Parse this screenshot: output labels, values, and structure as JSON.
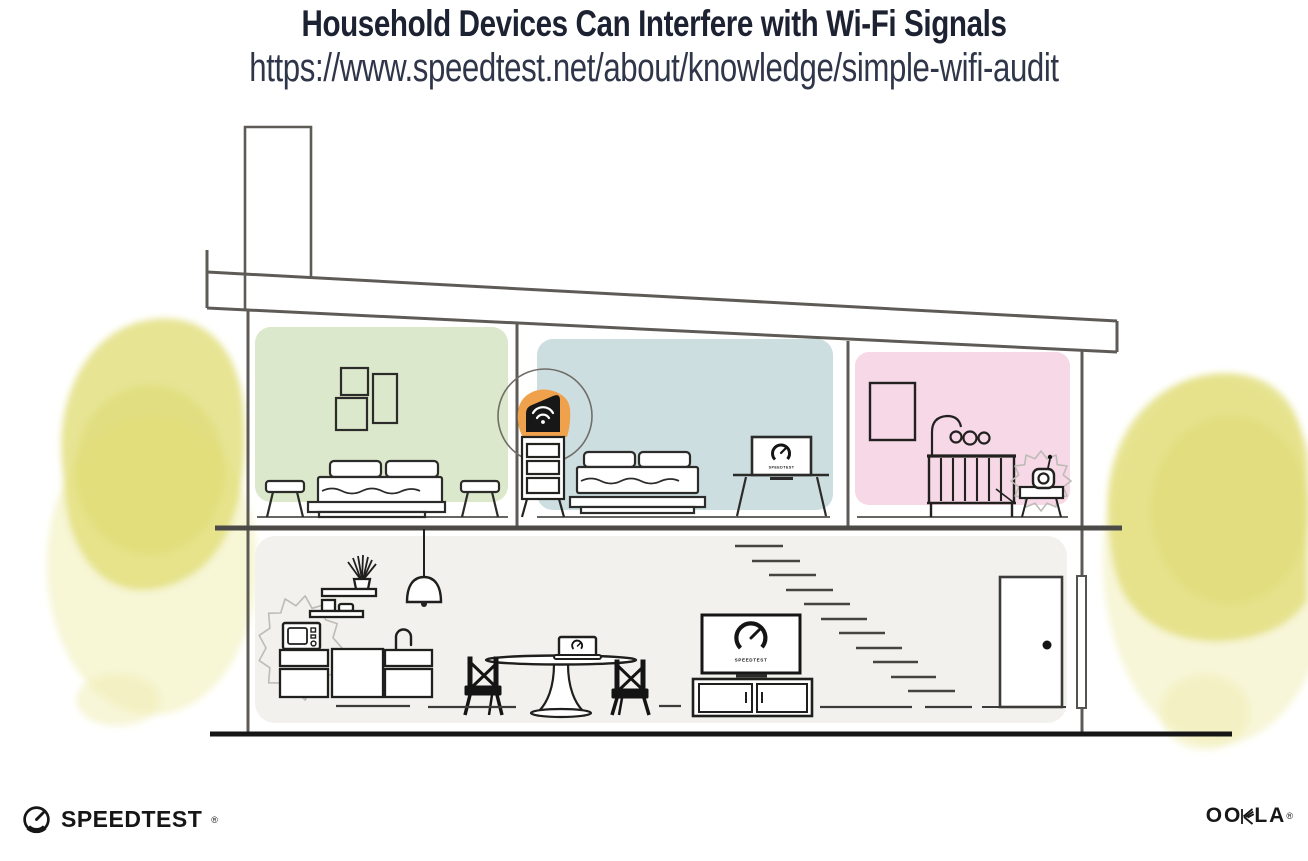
{
  "header": {
    "title": "Household Devices Can Interfere with Wi-Fi Signals",
    "url": "https://www.speedtest.net/about/knowledge/simple-wifi-audit"
  },
  "footer": {
    "speedtest_wordmark": "SPEEDTEST",
    "speedtest_trademark": "®",
    "ookla_wordmark_first": "OO",
    "ookla_wordmark_last": "LA",
    "ookla_trademark": "®"
  },
  "illustration": {
    "screens": {
      "bedroom_tv_label": "SPEEDTEST",
      "living_room_tv_label": "SPEEDTEST"
    },
    "icons": {
      "router": "wifi-icon",
      "bedroom_tv": "speedtest-gauge-icon",
      "living_room_tv": "speedtest-gauge-icon",
      "laptop": "speedtest-gauge-icon",
      "footer_speedtest": "speedtest-gauge-icon",
      "interference_microwave": "starburst-squiggle",
      "interference_baby_monitor": "starburst-squiggle"
    },
    "colors": {
      "bedroom_left_wall": "#dce8cb",
      "bedroom_middle_wall": "#cddee1",
      "nursery_wall": "#f6d8e6",
      "downstairs_wall": "#f2f1ee",
      "router_highlight": "#f0a14c",
      "foliage": "#e2de7b",
      "foliage_wash": "#f0eeb2",
      "title_text": "#1d2232"
    }
  }
}
